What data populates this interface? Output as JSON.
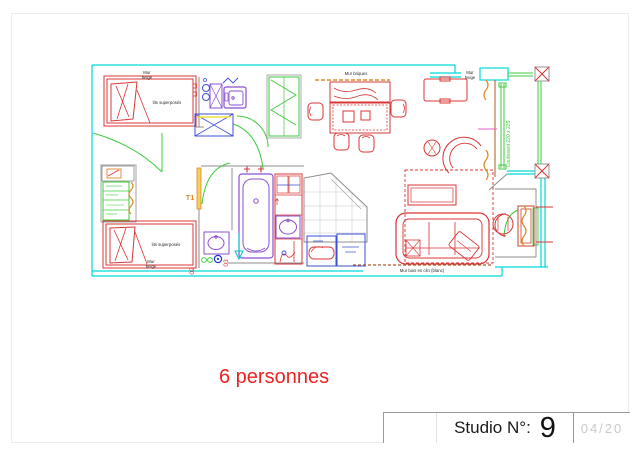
{
  "sheet": {
    "background": "#ffffff",
    "border_color": "#ededed"
  },
  "plan": {
    "room_type_label": "T1",
    "bed_label": "lits superposés",
    "sliding_door_label": "Coulissant 220 x 225",
    "wall_labels": {
      "mur": "Mur",
      "beige": "beige",
      "briques": "Mur briques",
      "bois_clin": "Mur bois en clin (blanc)"
    },
    "position_labels": {
      "p02": "02",
      "p03": "03"
    },
    "colors": {
      "wall_cyan": "#00d9d9",
      "furniture_red": "#d93434",
      "door_green": "#3ecb3e",
      "sanitary_purple": "#8a4fd0",
      "kitchen_blue": "#3a4fd9",
      "accent_orange": "#e2882a",
      "wood_brown": "#b05a2a",
      "outline_gray": "#8c8c8c",
      "label_black": "#2a2a2a",
      "highlight_yellow": "#f0e040",
      "magenta": "#e060c0",
      "annotation_red": "#ee2222"
    }
  },
  "annotation": {
    "capacity_text": "6 personnes"
  },
  "title_block": {
    "label": "Studio N°:",
    "number": "9",
    "page_ref": "04/20"
  }
}
